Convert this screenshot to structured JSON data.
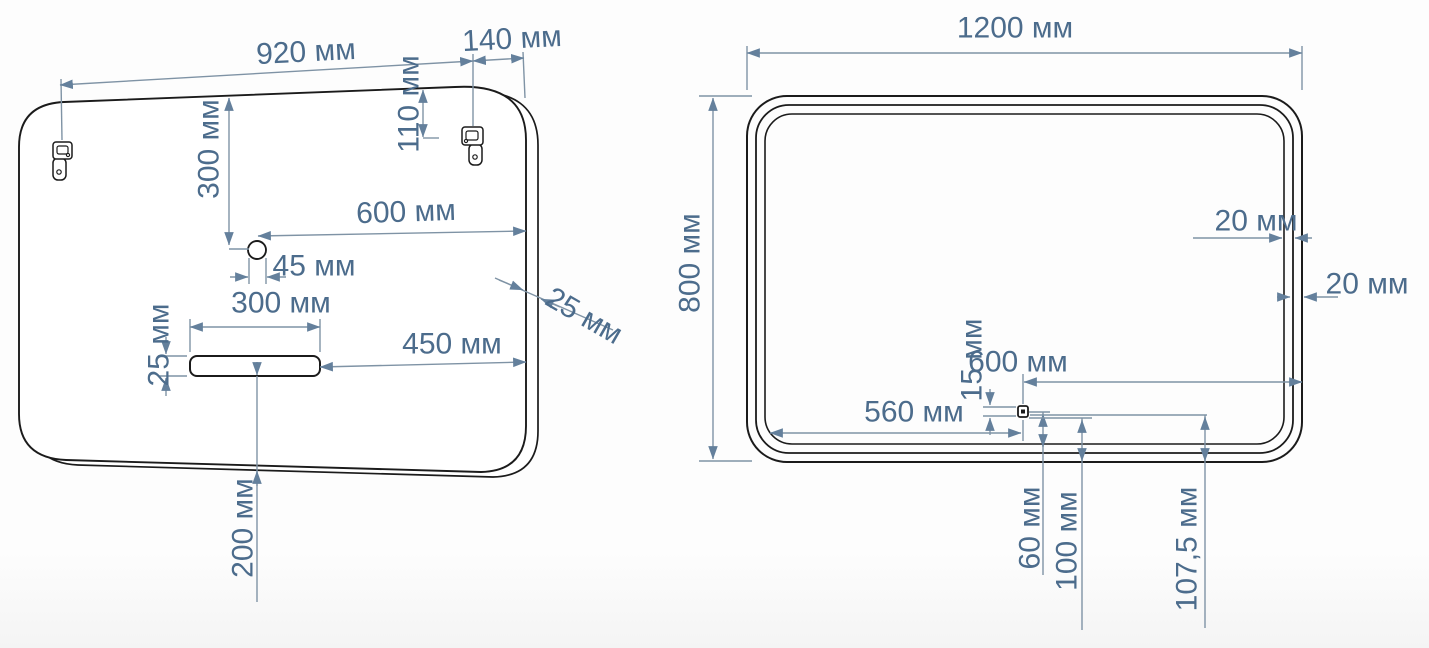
{
  "drawing": {
    "title": "mirror-installation-blueprint",
    "unit": "мм",
    "colors": {
      "dimension_text": "#4c6c8c",
      "dimension_line": "#7f93a5",
      "outline": "#1b1b1b",
      "background": "#fdfdfd"
    },
    "back_view": {
      "dimensions": {
        "mount_span": "920 мм",
        "mount_to_edge": "140 мм",
        "mount_from_top": "110 мм",
        "hole_from_top": "300 мм",
        "hole_to_edge": "600 мм",
        "hole_diameter": "45 мм",
        "slot_width": "300 мм",
        "slot_height": "25 мм",
        "slot_to_edge": "450 мм",
        "mirror_thickness": "25 мм",
        "slot_from_bottom": "200 мм"
      }
    },
    "front_view": {
      "dimensions": {
        "width": "1200 мм",
        "height": "800 мм",
        "frame_gap_1": "20 мм",
        "frame_gap_2": "20 мм",
        "sensor_height": "15 мм",
        "sensor_to_right_edge": "600 мм",
        "sensor_to_left_edge": "560 мм",
        "sensor_offset_1": "60 мм",
        "sensor_offset_2": "100 мм",
        "sensor_offset_3": "107,5 мм"
      }
    }
  }
}
